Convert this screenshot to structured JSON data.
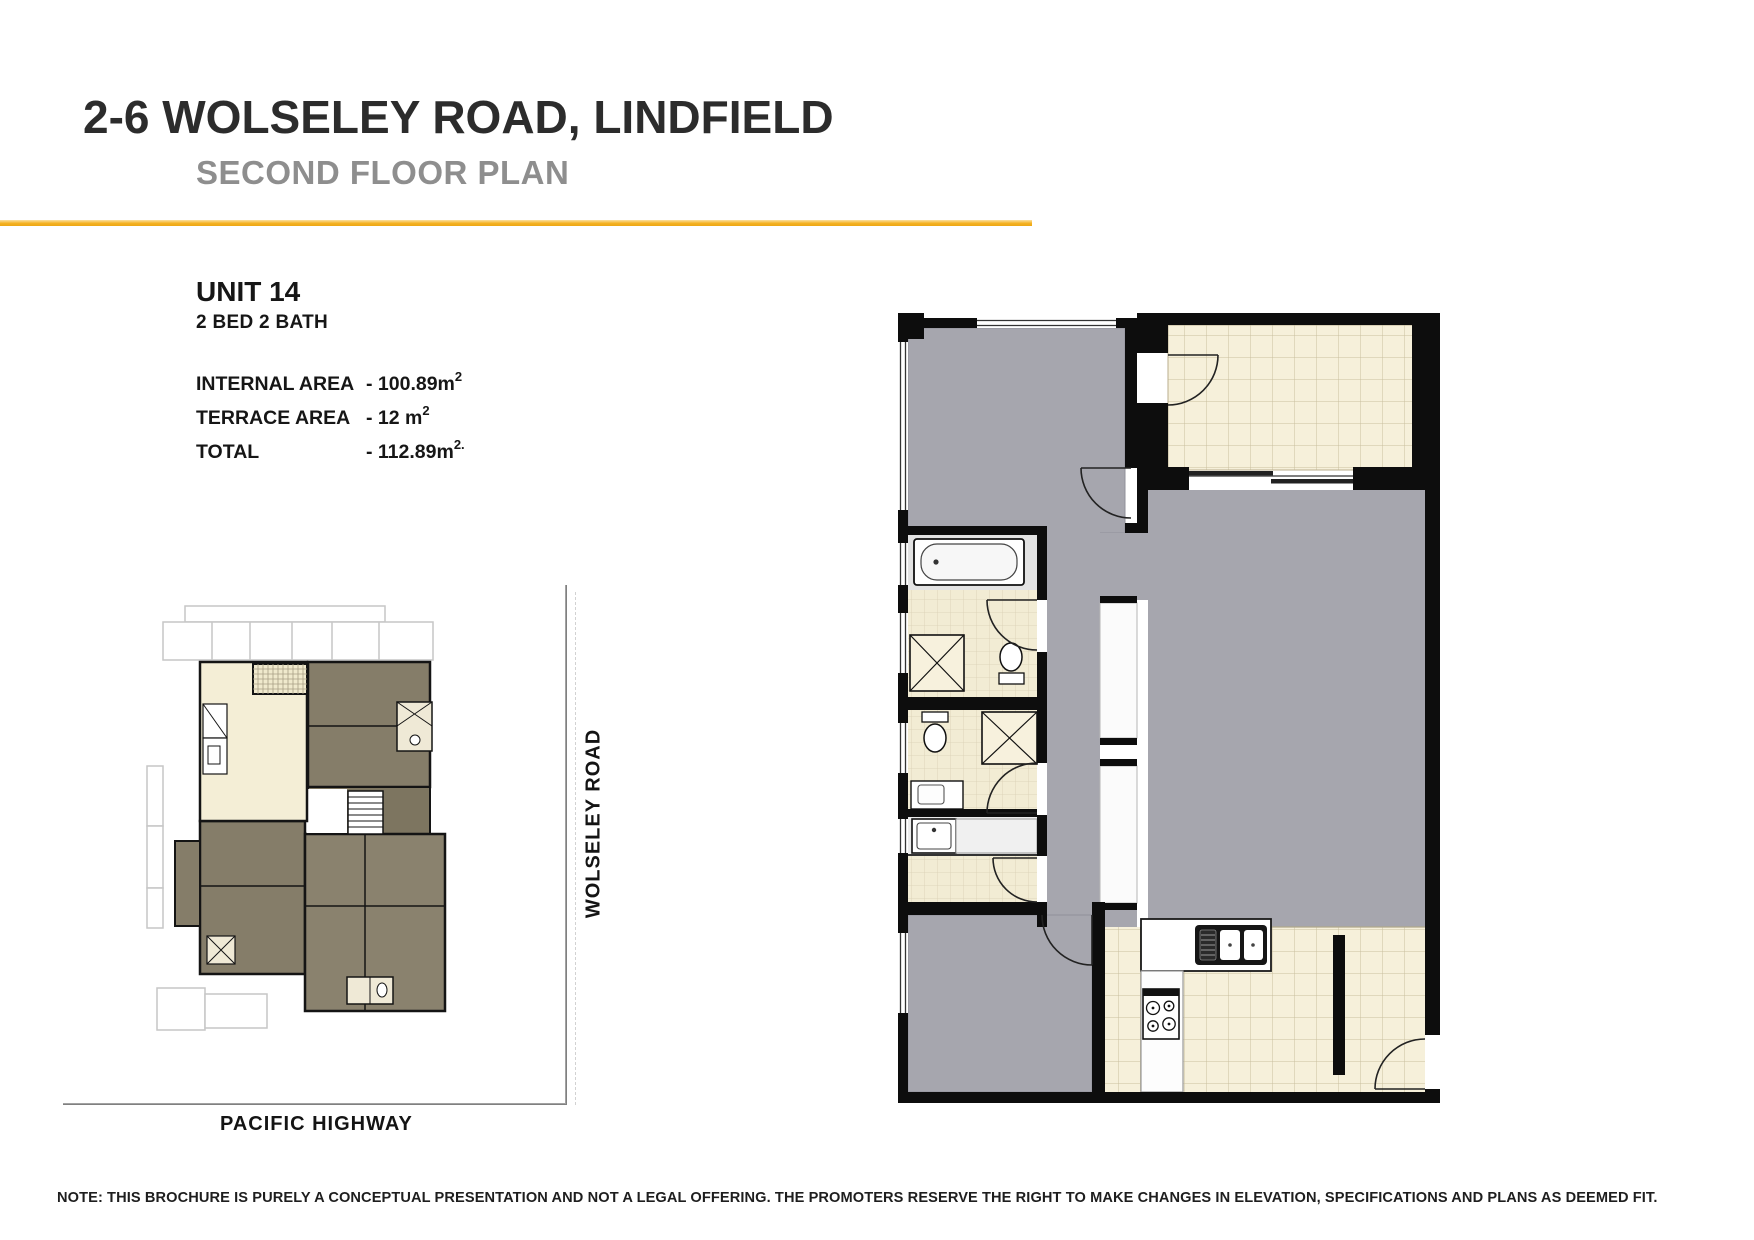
{
  "header": {
    "title": "2-6 WOLSELEY ROAD, LINDFIELD",
    "subtitle": "SECOND FLOOR PLAN",
    "accent_color": "#F4B223"
  },
  "unit": {
    "name": "UNIT 14",
    "config": "2 BED 2 BATH",
    "areas": [
      {
        "label": "INTERNAL AREA",
        "value": "- 100.89m",
        "sup": "2"
      },
      {
        "label": "TERRACE AREA",
        "value": "- 12 m",
        "sup": "2"
      },
      {
        "label": "TOTAL",
        "value": "- 112.89m",
        "sup": "2."
      }
    ]
  },
  "roads": {
    "vertical_label": "WOLSELEY ROAD",
    "horizontal_label": "PACIFIC HIGHWAY"
  },
  "plan": {
    "colors": {
      "carpet_gray": "#A6A6AE",
      "terrace_tile": "#F6F0DA",
      "bath_tile": "#F2ECD4",
      "wall_black": "#0D0D0D",
      "site_neighbor_unit": "#857D69",
      "site_unit14_highlight": "#F4EED6"
    }
  },
  "footer": {
    "note": "NOTE: THIS BROCHURE IS PURELY A CONCEPTUAL PRESENTATION AND NOT A LEGAL OFFERING. THE PROMOTERS RESERVE THE RIGHT TO MAKE CHANGES IN ELEVATION, SPECIFICATIONS AND PLANS AS DEEMED FIT."
  }
}
